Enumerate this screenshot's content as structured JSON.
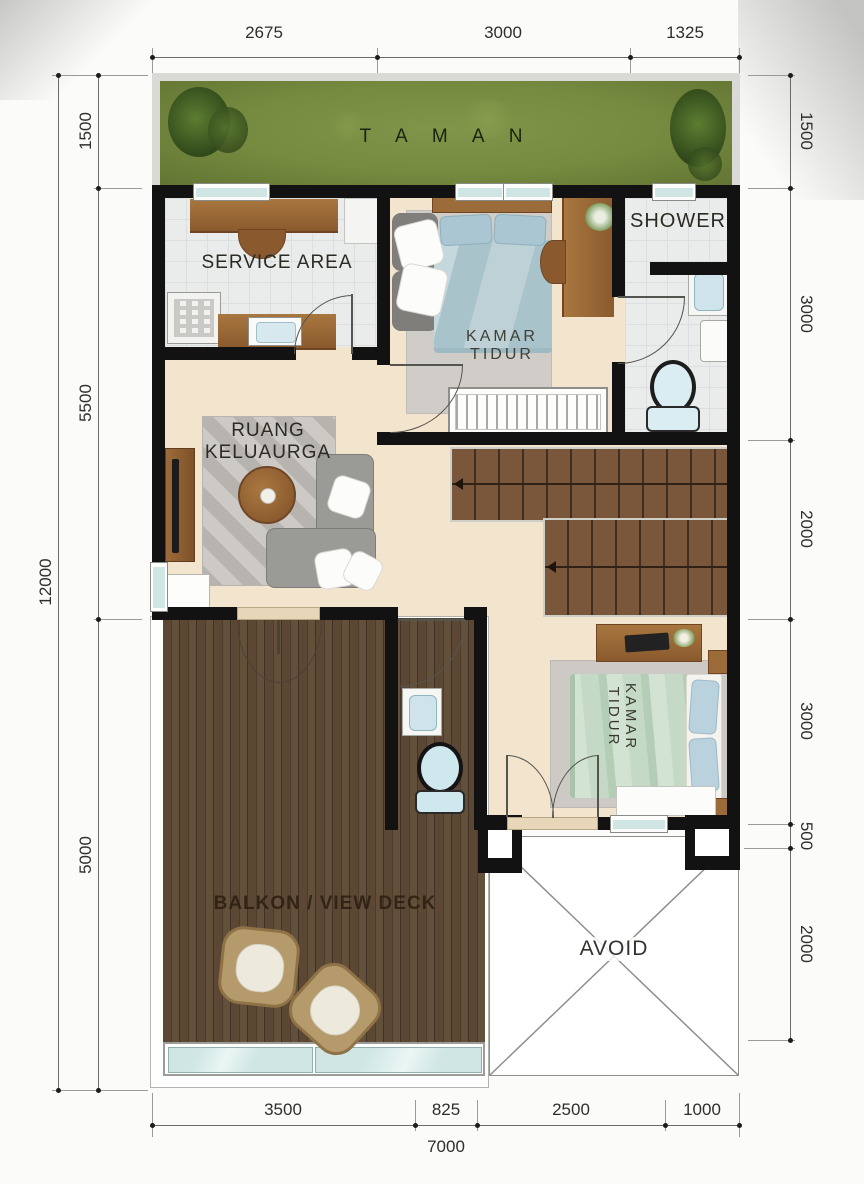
{
  "plan": {
    "rooms": {
      "taman": "T A M A N",
      "service": "SERVICE AREA",
      "bedroom1_l1": "KAMAR",
      "bedroom1_l2": "TIDUR",
      "shower": "SHOWER",
      "living": "RUANG KELUAURGA",
      "bedroom2_l1": "KAMAR",
      "bedroom2_l2": "TIDUR",
      "balcony": "BALKON / VIEW DECK",
      "void": "AVOID"
    }
  },
  "dims": {
    "top": [
      "2675",
      "3000",
      "1325"
    ],
    "left": [
      "1500",
      "5500",
      "5000"
    ],
    "left_total": "12000",
    "right": [
      "1500",
      "3000",
      "2000",
      "3000",
      "500",
      "2000"
    ],
    "bottom": [
      "3500",
      "825",
      "2500",
      "1000"
    ],
    "bottom_total": "7000"
  },
  "colors": {
    "wall": "#121212",
    "grass": "#75893f",
    "floor": "#f3e4cd",
    "tile": "#eaecec",
    "deck": "#57432f",
    "stair": "#6f4e34",
    "glass": "#cfe6e4",
    "bed1": "#b6cfd6",
    "bed2": "#c4dac6",
    "sofa": "#9a9a96",
    "wood": "#9c6b3a",
    "dim_text": "#2e2e2e"
  }
}
